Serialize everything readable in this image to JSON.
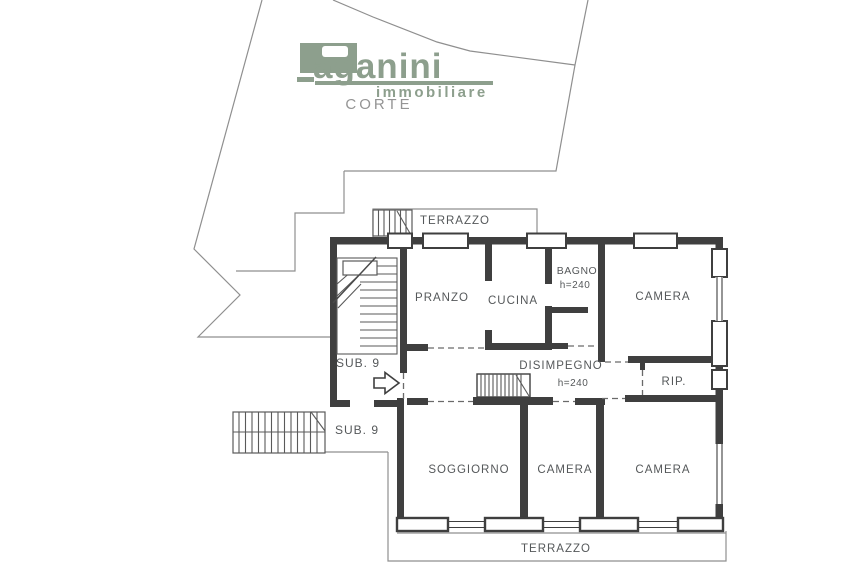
{
  "colors": {
    "logo-green": "#8d9f8d",
    "wall": "#3f3f3f",
    "line": "#8f8f8f",
    "hatch": "#5a5a5a",
    "dash": "#6a6a6a",
    "text": "#55585a",
    "muted": "#949494"
  },
  "logo": {
    "initial": "P",
    "name_rest": "aganini",
    "subtitle": "immobiliare"
  },
  "site": {
    "courtyard": "CORTE"
  },
  "plan": {
    "terrace_top": "TERRAZZO",
    "terrace_bottom": "TERRAZZO",
    "pranzo": "PRANZO",
    "cucina": "CUCINA",
    "bagno": "BAGNO",
    "bagno_height": "h=240",
    "camera_top_right": "CAMERA",
    "sub9_stairwell": "SUB. 9",
    "sub9_lower": "SUB. 9",
    "disimpegno": "DISIMPEGNO",
    "disimpegno_height": "h=240",
    "rip": "RIP.",
    "soggiorno": "SOGGIORNO",
    "camera_bottom_middle": "CAMERA",
    "camera_bottom_right": "CAMERA"
  }
}
